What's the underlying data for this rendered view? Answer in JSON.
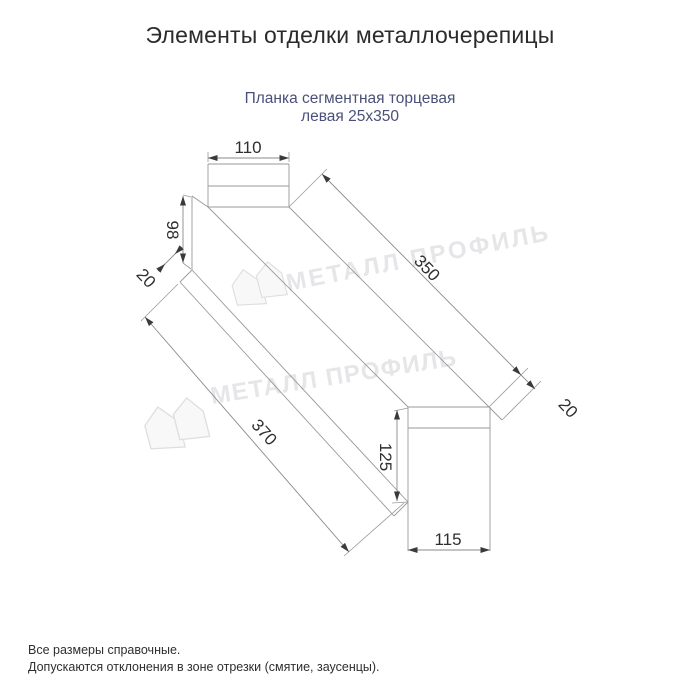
{
  "header": {
    "title": "Элементы отделки металлочерепицы"
  },
  "product": {
    "line1": "Планка сегментная торцевая",
    "line2": "левая 25х350"
  },
  "dims": {
    "top_width": "110",
    "left_height": "98",
    "left_hem": "20",
    "top_length": "350",
    "bottom_length": "370",
    "right_hem": "20",
    "right_height": "125",
    "bottom_width": "115"
  },
  "watermark": {
    "brand": "МЕТАЛЛ ПРОФИЛЬ"
  },
  "footer": {
    "note1": "Все размеры справочные.",
    "note2": "Допускаются отклонения в зоне отрезки (смятие, заусенцы)."
  },
  "colors": {
    "line": "#98989a",
    "dimension_text": "#2e2e2e",
    "subtitle_text": "#4a5078",
    "watermark": "#e6e6e9"
  }
}
